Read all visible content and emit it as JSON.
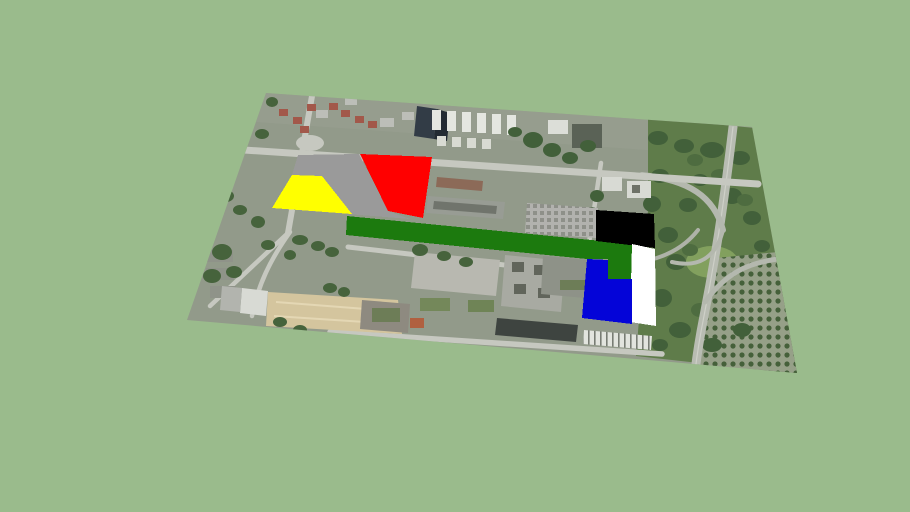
{
  "scene": {
    "type": "3d-model-viewport",
    "description": "Perspective view of a satellite aerial photo plane lying on a sage-green ground, with flat colored site-plan parcel overlays (gray, yellow, red, dark-green strip, black, white, blue) drawn over the urban area",
    "background_color": "#9abb8c"
  },
  "aerial": {
    "name": "satellite-ground-plane",
    "outline_points": "266,93 752,127 797,373 187,320",
    "base_color": "#929a8a"
  },
  "overlays": [
    {
      "id": "gray-parcel",
      "color": "#9a9a9a",
      "points": "298,155 359,154 388,211 410,219 272,208 292,175"
    },
    {
      "id": "yellow-parcel",
      "color": "#ffff00",
      "points": "292,175 322,176 352,214 272,208"
    },
    {
      "id": "red-parcel",
      "color": "#ff0000",
      "points": "360,154 432,157 423,218 388,211"
    },
    {
      "id": "green-strip",
      "color": "#1c7a0e",
      "points": "347,216 632,244 632,279 608,279 608,259 587,259 346,235"
    },
    {
      "id": "black-parcel",
      "color": "#000000",
      "points": "596,210 654,214 655,248 596,241"
    },
    {
      "id": "white-parcel",
      "color": "#ffffff",
      "points": "632,244 655,249 656,326 630,322"
    },
    {
      "id": "blue-parcel",
      "color": "#0404d8",
      "points": "587,259 608,260 608,279 632,279 632,324 582,318"
    }
  ]
}
